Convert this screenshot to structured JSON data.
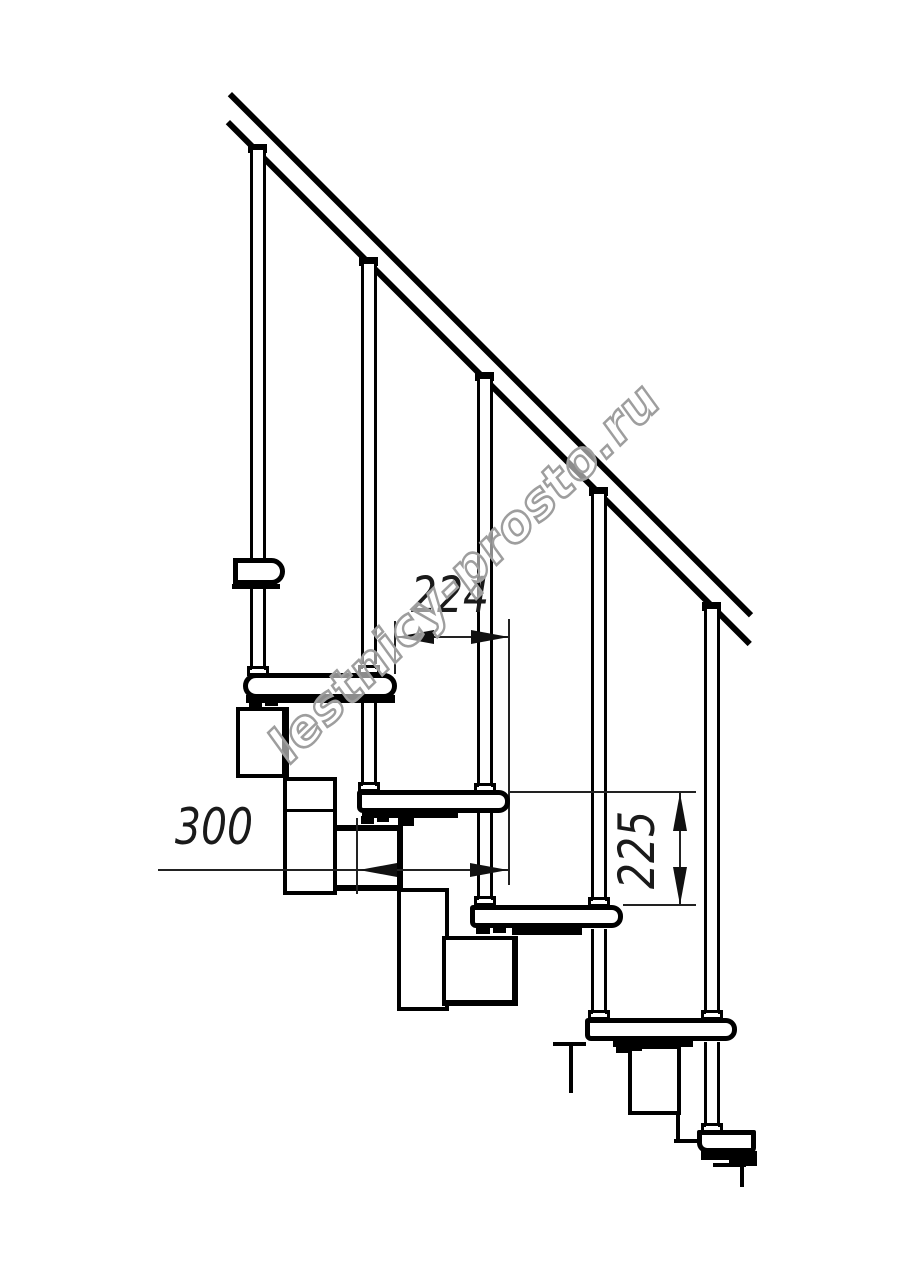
{
  "watermark": {
    "text": "lestnicy-prosto.ru",
    "outline_color": "#9e9e9e",
    "rotation_deg": -44
  },
  "dimensions": {
    "going": "224",
    "depth": "300",
    "rise": "225"
  },
  "colors": {
    "background": "#ffffff",
    "ink": "#000000",
    "dimension_ink": "#1f1f1f"
  },
  "structure": {
    "handrail_lines": 2,
    "balusters": 5,
    "treads": 5,
    "support_modules": 5,
    "upper_floor_bracket": 1
  }
}
